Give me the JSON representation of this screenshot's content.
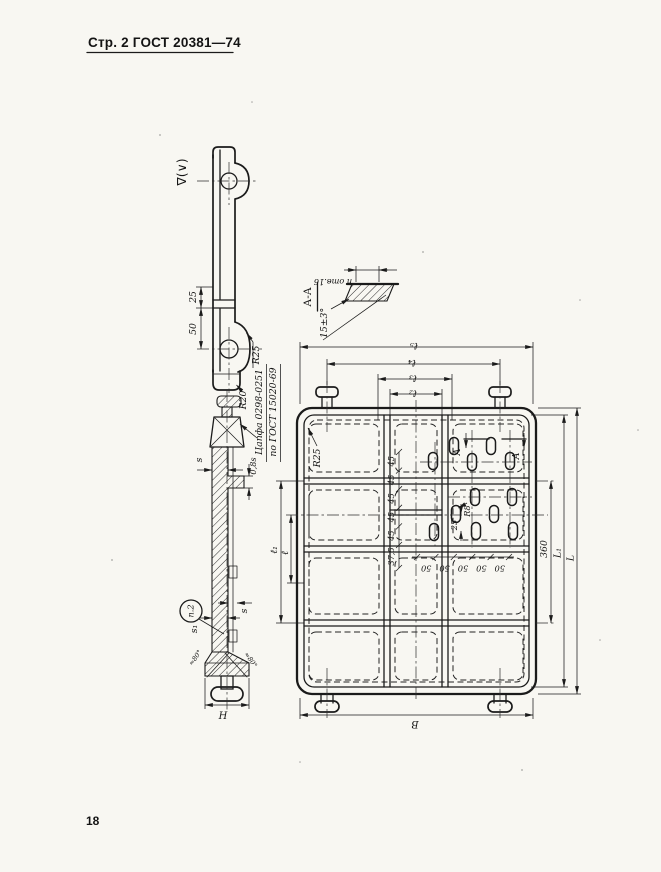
{
  "colors": {
    "ink": "#1b1b1b",
    "paper": "#f8f7f2"
  },
  "page": {
    "header": "Стр. 2 ГОСТ 20381—74",
    "page_number": "18"
  },
  "profile_view": {
    "roughness_mark": "∇(∨)",
    "dim_wall": "25",
    "dim_hole": "50",
    "r_lug": "R25",
    "r_foot": "R20"
  },
  "trunnion_callout": {
    "line1": "Цапфа 0298-0251",
    "line2": "по ГОСТ 15020-69"
  },
  "section_view": {
    "dim_s_wall": "s",
    "dim_rib": "0,8s",
    "dim_s_rib": "s",
    "dim_s1": "s₁",
    "dim_height": "H",
    "note_circle": "п.2",
    "draft_left": "≈80°",
    "draft_right": "≈80°"
  },
  "section_aa": {
    "title": "А-А",
    "holes_note": "п отв.16",
    "angle": "15±3°"
  },
  "main_view": {
    "corner_radius": "R25",
    "slot_radius": "R8",
    "dim_slot_offset": "25",
    "dim_37_5": "37,5",
    "top_dims": {
      "l5": "ℓ₅",
      "l4": "ℓ₄",
      "l3": "ℓ₃",
      "l2": "ℓ₂"
    },
    "left_dims": {
      "l1": "ℓ₁",
      "l": "ℓ"
    },
    "right_dims": {
      "d360": "360",
      "L1": "L₁",
      "L": "L"
    },
    "bottom_dim": "В",
    "chain_45": [
      "45",
      "45",
      "45",
      "45",
      "45"
    ],
    "chain_50": [
      "50",
      "50",
      "50",
      "50",
      "50"
    ],
    "section_mark_left": "А",
    "section_mark_right": "А"
  }
}
